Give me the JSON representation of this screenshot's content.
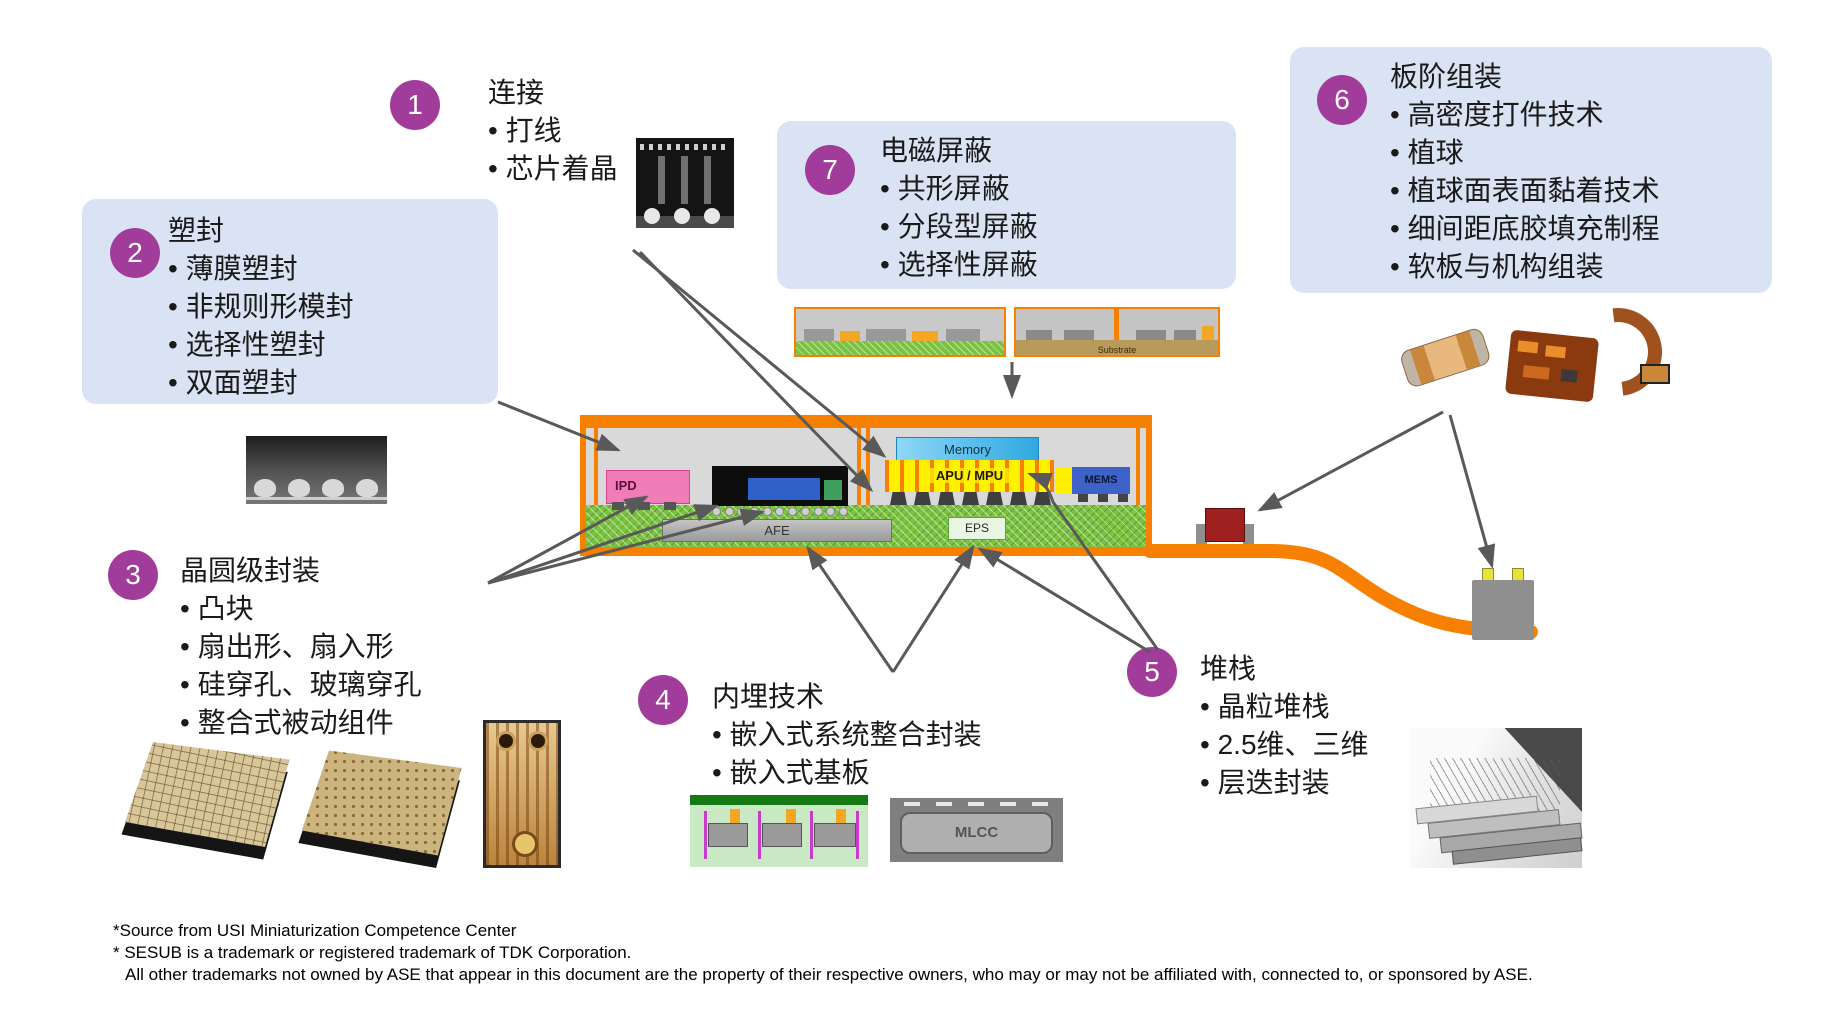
{
  "callouts": [
    {
      "num": "1",
      "title": "连接",
      "bullets": [
        "打线",
        "芯片着晶"
      ]
    },
    {
      "num": "2",
      "title": "塑封",
      "bullets": [
        "薄膜塑封",
        "非规则形模封",
        "选择性塑封",
        "双面塑封"
      ]
    },
    {
      "num": "3",
      "title": "晶圆级封装",
      "bullets": [
        "凸块",
        "扇出形、扇入形",
        "硅穿孔、玻璃穿孔",
        "整合式被动组件"
      ]
    },
    {
      "num": "4",
      "title": "内埋技术",
      "bullets": [
        "嵌入式系统整合封装",
        "嵌入式基板"
      ]
    },
    {
      "num": "5",
      "title": "堆栈",
      "bullets": [
        "晶粒堆栈",
        "2.5维、三维",
        "层迭封装"
      ]
    },
    {
      "num": "6",
      "title": "板阶组装",
      "bullets": [
        "高密度打件技术",
        "植球",
        "植球面表面黏着技术",
        "细间距底胶填充制程",
        "软板与机构组装"
      ]
    },
    {
      "num": "7",
      "title": "电磁屏蔽",
      "bullets": [
        "共形屏蔽",
        "分段型屏蔽",
        "选择性屏蔽"
      ]
    }
  ],
  "package_diagram": {
    "blocks": {
      "ipd": "IPD",
      "memory": "Memory",
      "apu": "APU / MPU",
      "mems": "MEMS",
      "afe": "AFE",
      "eps": "EPS"
    }
  },
  "photo_labels": {
    "substrate": "Substrate",
    "mlcc": "MLCC"
  },
  "footnotes": [
    "*Source from USI Miniaturization Competence Center",
    "* SESUB is a trademark or registered trademark of TDK Corporation.",
    "All other trademarks not owned by ASE that appear in this document are the property of their respective owners, who may or may not be affiliated with, connected to, or sponsored by ASE."
  ],
  "colors": {
    "accent_purple": "#A13C9B",
    "callout_bg": "#DAE3F3",
    "package_orange": "#F88000",
    "substrate_green": "#7CC242",
    "arrow_gray": "#595959"
  }
}
